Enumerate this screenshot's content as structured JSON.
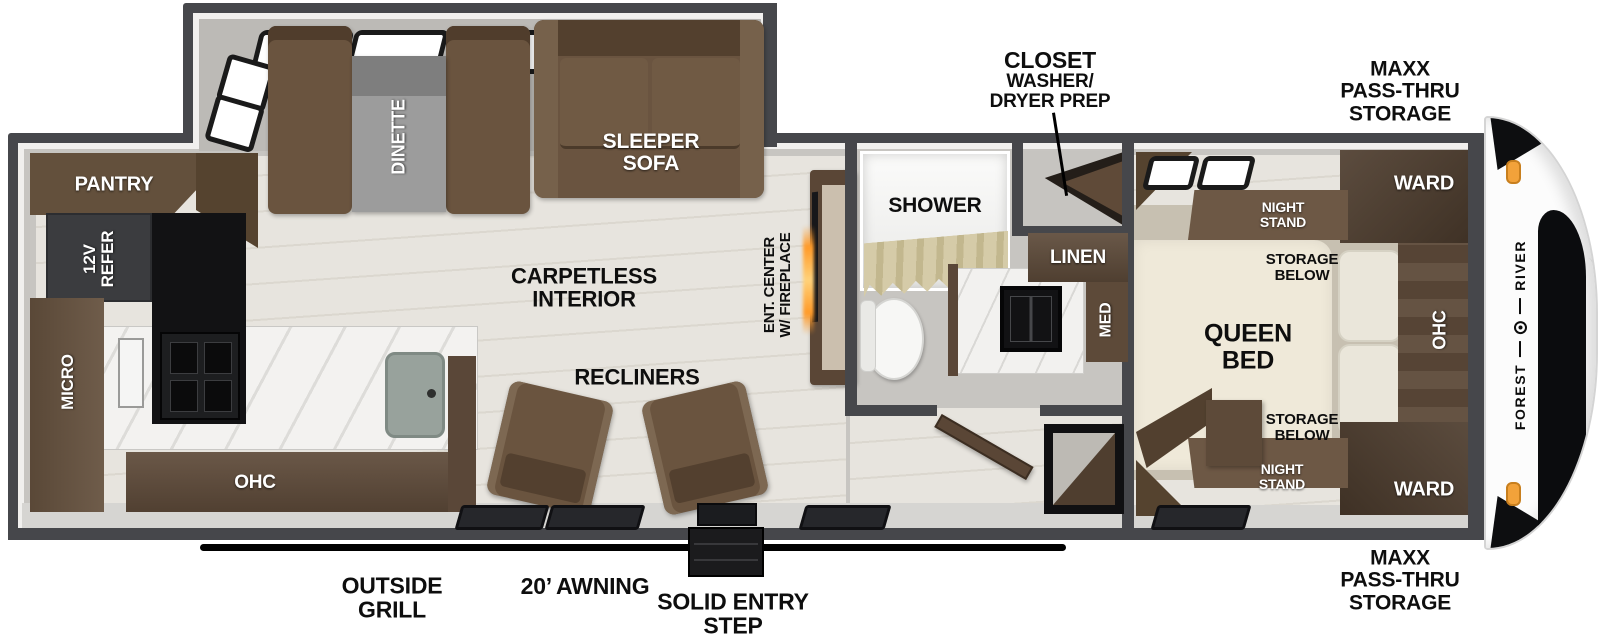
{
  "labels": {
    "pantry": "PANTRY",
    "refer": "12V\nREFER",
    "micro": "MICRO",
    "kitchen_ohc": "OHC",
    "dinette": "DINETTE",
    "sleeper_sofa": "SLEEPER\nSOFA",
    "carpetless": "CARPETLESS\nINTERIOR",
    "recliners": "RECLINERS",
    "ent_center": "ENT. CENTER\nW/ FIREPLACE",
    "shower": "SHOWER",
    "linen": "LINEN",
    "med": "MED",
    "closet_title": "CLOSET",
    "closet_sub": "WASHER/\nDRYER PREP",
    "night_stand": "NIGHT\nSTAND",
    "storage_below": "STORAGE\nBELOW",
    "queen_bed": "QUEEN\nBED",
    "ward": "WARD",
    "bedroom_ohc": "OHC",
    "maxx_storage": "MAXX\nPASS-THRU\nSTORAGE",
    "outside_grill": "OUTSIDE\nGRILL",
    "awning": "20’ AWNING",
    "entry_step": "SOLID ENTRY\nSTEP",
    "brand_forest": "FOREST",
    "brand_river": "RIVER"
  },
  "colors": {
    "wall": "#46474b",
    "floor_wood": "#e5e2db",
    "furniture_brown": "#6a543f",
    "cabinet_dark_brown": "#4e3d2e",
    "bed_cream": "#efe9d9",
    "counter_white": "#f3f2f0",
    "appliance_black": "#141416",
    "refrigerator_gray": "#3b3c3f",
    "marker_light_orange": "#f2a23a",
    "fireplace_glow": "#ff9a28",
    "shower_curtain_tan": "#cfc5a2",
    "awning_black": "#000000"
  }
}
